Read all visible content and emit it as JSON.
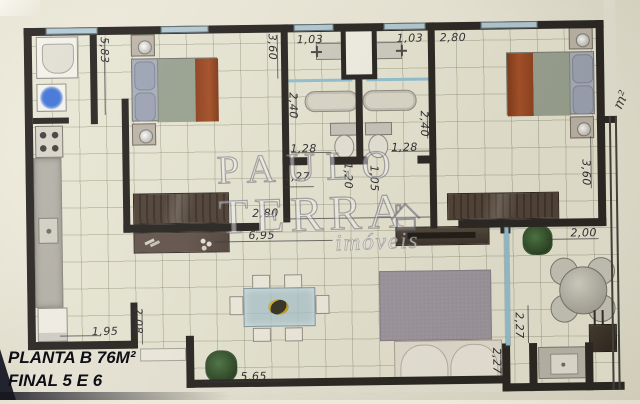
{
  "labels": {
    "plan_title": "PLANTA B 76M²",
    "plan_subtitle": "FINAL 5 E 6",
    "area_unit": "m²"
  },
  "watermark": {
    "brand_top": "PAULO",
    "brand_bottom": "TERRA",
    "tagline": "imóveis",
    "logo_icon": "house-icon"
  },
  "dimensions": [
    {
      "id": "kitchen-length",
      "text": "5,83"
    },
    {
      "id": "bedroom1-width",
      "text": "3,60"
    },
    {
      "id": "bathroom1-window",
      "text": "1,03"
    },
    {
      "id": "bathroom2-window",
      "text": "1,03"
    },
    {
      "id": "bedroom2-top",
      "text": "2,80"
    },
    {
      "id": "bathroom1-depth",
      "text": "2,40"
    },
    {
      "id": "bathroom2-depth",
      "text": "2,40"
    },
    {
      "id": "bathroom1-shower",
      "text": "1,28"
    },
    {
      "id": "bathroom2-shower",
      "text": "1,28"
    },
    {
      "id": "hall-left",
      "text": "1,27"
    },
    {
      "id": "bathroom1-door",
      "text": "1,20"
    },
    {
      "id": "bathroom2-door",
      "text": "1,05"
    },
    {
      "id": "hall-width",
      "text": "2,80"
    },
    {
      "id": "living-width",
      "text": "6,95"
    },
    {
      "id": "bedroom2-width",
      "text": "3,60"
    },
    {
      "id": "balcony-width",
      "text": "2,00"
    },
    {
      "id": "balcony-depth-upper",
      "text": "2,27"
    },
    {
      "id": "balcony-depth-lower",
      "text": "2,27"
    },
    {
      "id": "kitchen-bottom",
      "text": "1,95"
    },
    {
      "id": "entry-depth",
      "text": "2,08"
    },
    {
      "id": "living-bottom",
      "text": "5,65"
    }
  ],
  "colors": {
    "wall": "#201d1b",
    "floor": "#e9e7d5",
    "floor_grid": "#7d8769",
    "paper": "#e9e6d8",
    "window_glass": "#b2c9d4",
    "glass_partition": "#8fc0d4",
    "bed_blanket_orange": "#99401b",
    "bed_blanket_green": "#97a090",
    "pillow_gray": "#9aa2b4",
    "wood_dark": "#40342c",
    "rug_gray": "#98929c",
    "dining_glass": "#b9cdd6",
    "plant_green": "#2c4b28",
    "counter_gray": "#b2afa7",
    "sofa_cream": "#eae6dc",
    "watermark_fill": "rgba(252,252,255,0.30)"
  }
}
